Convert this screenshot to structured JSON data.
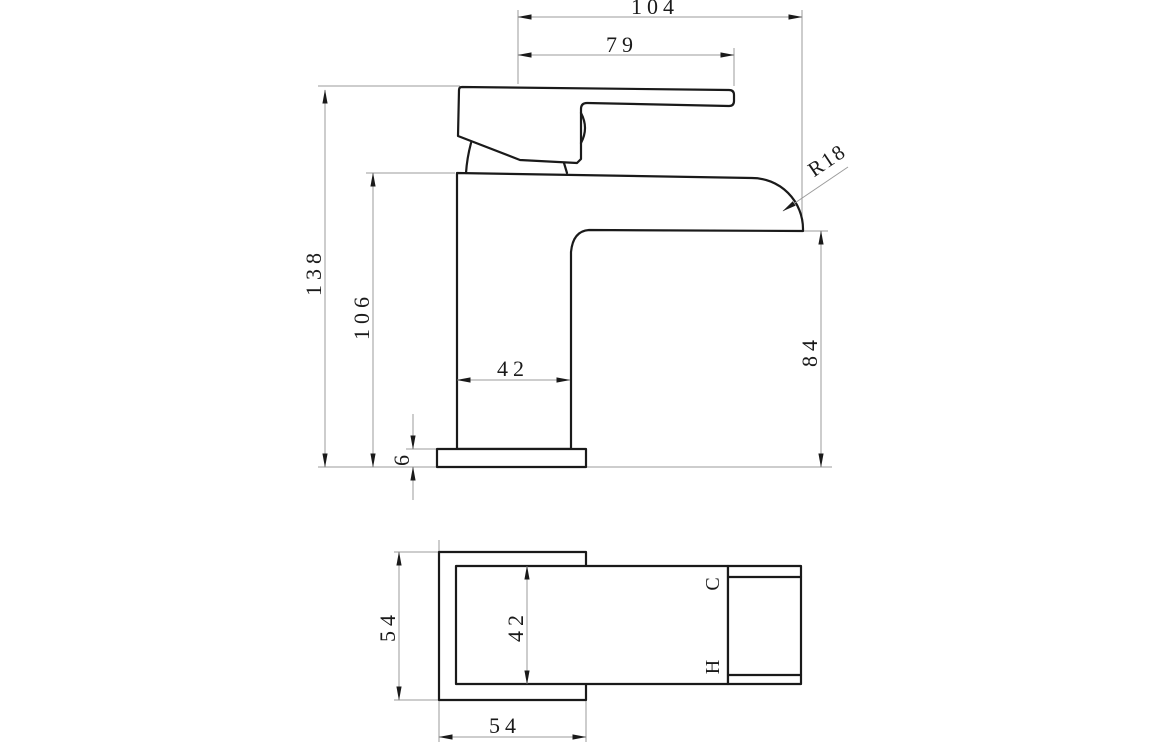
{
  "colors": {
    "object_line": "#1a1a1a",
    "dimension_line": "#9b9b9b",
    "background": "#ffffff"
  },
  "side_view": {
    "dim_overall_width": "104",
    "dim_handle_reach": "79",
    "dim_overall_height": "138",
    "dim_body_height": "106",
    "dim_body_width": "42",
    "dim_base_thickness": "6",
    "dim_spout_height": "84",
    "dim_spout_radius": "R18"
  },
  "plan_view": {
    "dim_base_depth": "54",
    "dim_base_width": "54",
    "dim_body_depth": "42",
    "label_cold": "C",
    "label_hot": "H"
  }
}
